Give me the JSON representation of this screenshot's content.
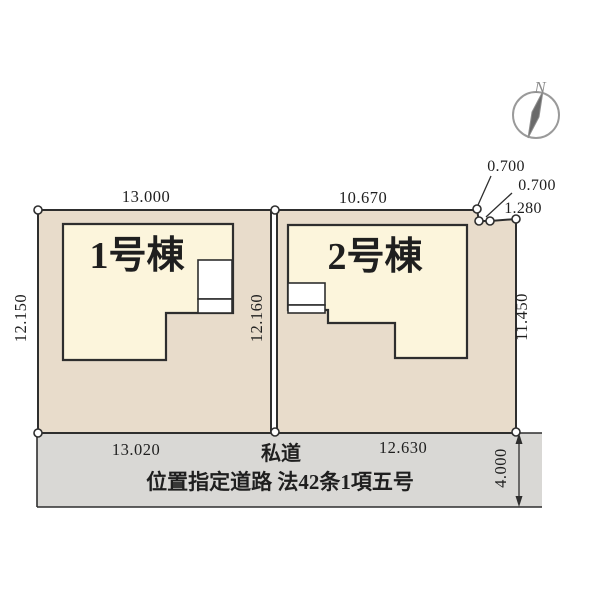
{
  "compass": {
    "north_label": "N"
  },
  "lots": {
    "lot1": {
      "name": "1号棟",
      "dim_top": "13.000",
      "dim_left": "12.150",
      "dim_bottom": "13.020"
    },
    "lot2": {
      "name": "2号棟",
      "dim_top": "10.670",
      "dim_right": "11.450",
      "dim_bottom": "12.630",
      "corner_dims": [
        "0.700",
        "0.700",
        "1.280"
      ]
    },
    "dim_middle": "12.160"
  },
  "road": {
    "label": "私道",
    "regulation": "位置指定道路 法42条1項五号",
    "dim_width": "4.000"
  },
  "colors": {
    "lot_fill": "#e8dccb",
    "building_fill": "#fcf5dc",
    "road_fill": "#d9d8d5",
    "porch_fill": "#ffffff",
    "line": "#2e2e2e",
    "compass_gray": "#8f8f8f"
  }
}
